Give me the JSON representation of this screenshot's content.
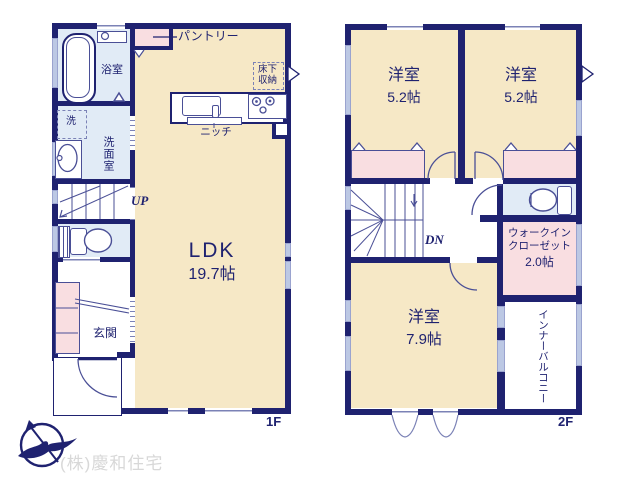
{
  "colors": {
    "wall": "#1f2270",
    "room_cream": "#f6e8c6",
    "room_pink": "#f9dee1",
    "room_blue": "#e1ebf6",
    "window": "#bcc8e4",
    "watermark": "#d8d8d8"
  },
  "floor1": {
    "floor_label": "1F",
    "bath_label": "浴室",
    "washer_label": "洗",
    "washroom_label": "洗面室",
    "stairs_label": "UP",
    "ldk_label": "LDK",
    "ldk_size": "19.7帖",
    "entrance_label": "玄関",
    "pantry_label": "パントリー",
    "floor_storage_line1": "床下",
    "floor_storage_line2": "収納",
    "niche_label": "ニッチ"
  },
  "floor2": {
    "floor_label": "2F",
    "bedroom_a_label": "洋室",
    "bedroom_a_size": "5.2帖",
    "bedroom_b_label": "洋室",
    "bedroom_b_size": "5.2帖",
    "bedroom_c_label": "洋室",
    "bedroom_c_size": "7.9帖",
    "stairs_label": "DN",
    "wic_line1": "ウォークイン",
    "wic_line2": "クローゼット",
    "wic_size": "2.0帖",
    "inner_balcony_label": "インナーバルコニー"
  },
  "footer": {
    "company": "(株)慶和住宅"
  }
}
